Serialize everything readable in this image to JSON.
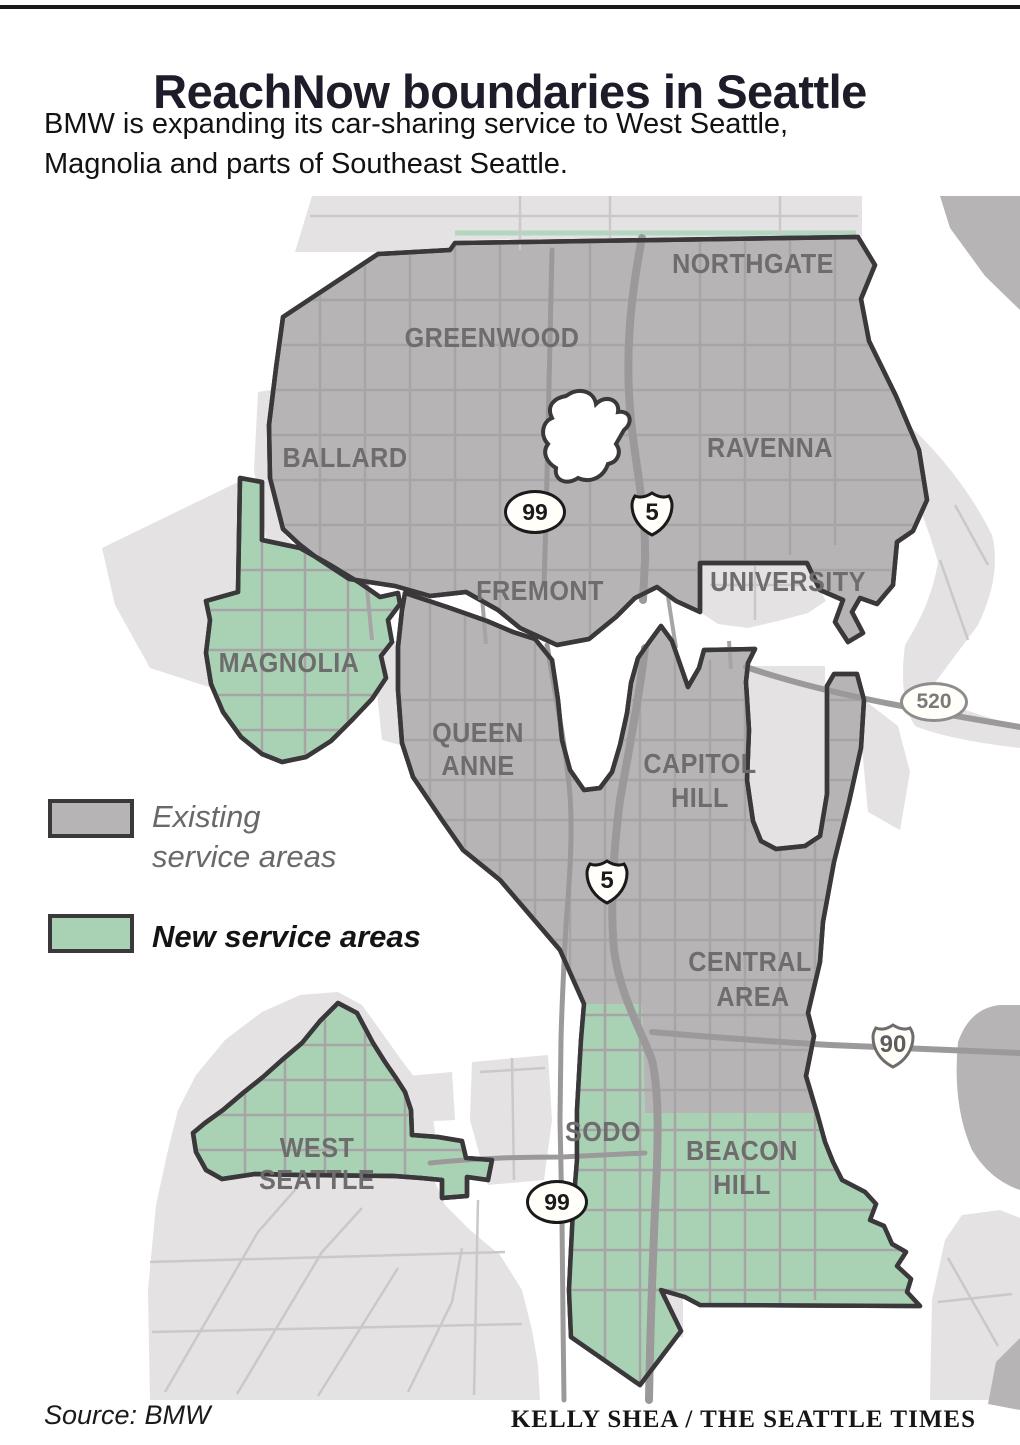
{
  "header": {
    "title": "ReachNow boundaries in Seattle",
    "subtitle_line1": "BMW is expanding its car-sharing service to West Seattle,",
    "subtitle_line2": "Magnolia and parts of Southeast Seattle."
  },
  "legend": {
    "existing_line1": "Existing",
    "existing_line2": "service areas",
    "new_label": "New service areas",
    "existing_color": "#b7b4b5",
    "new_color": "#a9d2b5"
  },
  "map": {
    "labels": [
      {
        "id": "northgate",
        "text": "NORTHGATE"
      },
      {
        "id": "greenwood",
        "text": "GREENWOOD"
      },
      {
        "id": "ballard",
        "text": "BALLARD"
      },
      {
        "id": "ravenna",
        "text": "RAVENNA"
      },
      {
        "id": "fremont",
        "text": "FREMONT"
      },
      {
        "id": "university",
        "text": "UNIVERSITY"
      },
      {
        "id": "magnolia",
        "text": "MAGNOLIA"
      },
      {
        "id": "queen-anne-line1",
        "text": "QUEEN"
      },
      {
        "id": "queen-anne-line2",
        "text": "ANNE"
      },
      {
        "id": "capitol-hill-line1",
        "text": "CAPITOL"
      },
      {
        "id": "capitol-hill-line2",
        "text": "HILL"
      },
      {
        "id": "central-area-line1",
        "text": "CENTRAL"
      },
      {
        "id": "central-area-line2",
        "text": "AREA"
      },
      {
        "id": "sodo",
        "text": "SODO"
      },
      {
        "id": "beacon-hill-line1",
        "text": "BEACON"
      },
      {
        "id": "beacon-hill-line2",
        "text": "HILL"
      },
      {
        "id": "west-seattle-line1",
        "text": "WEST"
      },
      {
        "id": "west-seattle-line2",
        "text": "SEATTLE"
      }
    ],
    "shields": [
      {
        "id": "us99-north",
        "type": "us-route",
        "text": "99"
      },
      {
        "id": "i5-north",
        "type": "interstate",
        "text": "5"
      },
      {
        "id": "sr520",
        "type": "state-route",
        "text": "520"
      },
      {
        "id": "i5-downtown",
        "type": "interstate",
        "text": "5"
      },
      {
        "id": "i90",
        "type": "interstate",
        "text": "90"
      },
      {
        "id": "us99-south",
        "type": "us-route",
        "text": "99"
      }
    ]
  },
  "footer": {
    "source": "Source: BMW",
    "credit": "KELLY SHEA / THE SEATTLE TIMES"
  },
  "colors": {
    "existing_area": "#b7b4b5",
    "new_area": "#a9d2b5",
    "nonservice_land": "#e4e2e3",
    "boundary": "#3a383a",
    "road": "#a7a4a5",
    "road_light": "#cac8c9",
    "freeway": "#9c999b",
    "label": "#6f6c6e",
    "title": "#1d1c29"
  }
}
